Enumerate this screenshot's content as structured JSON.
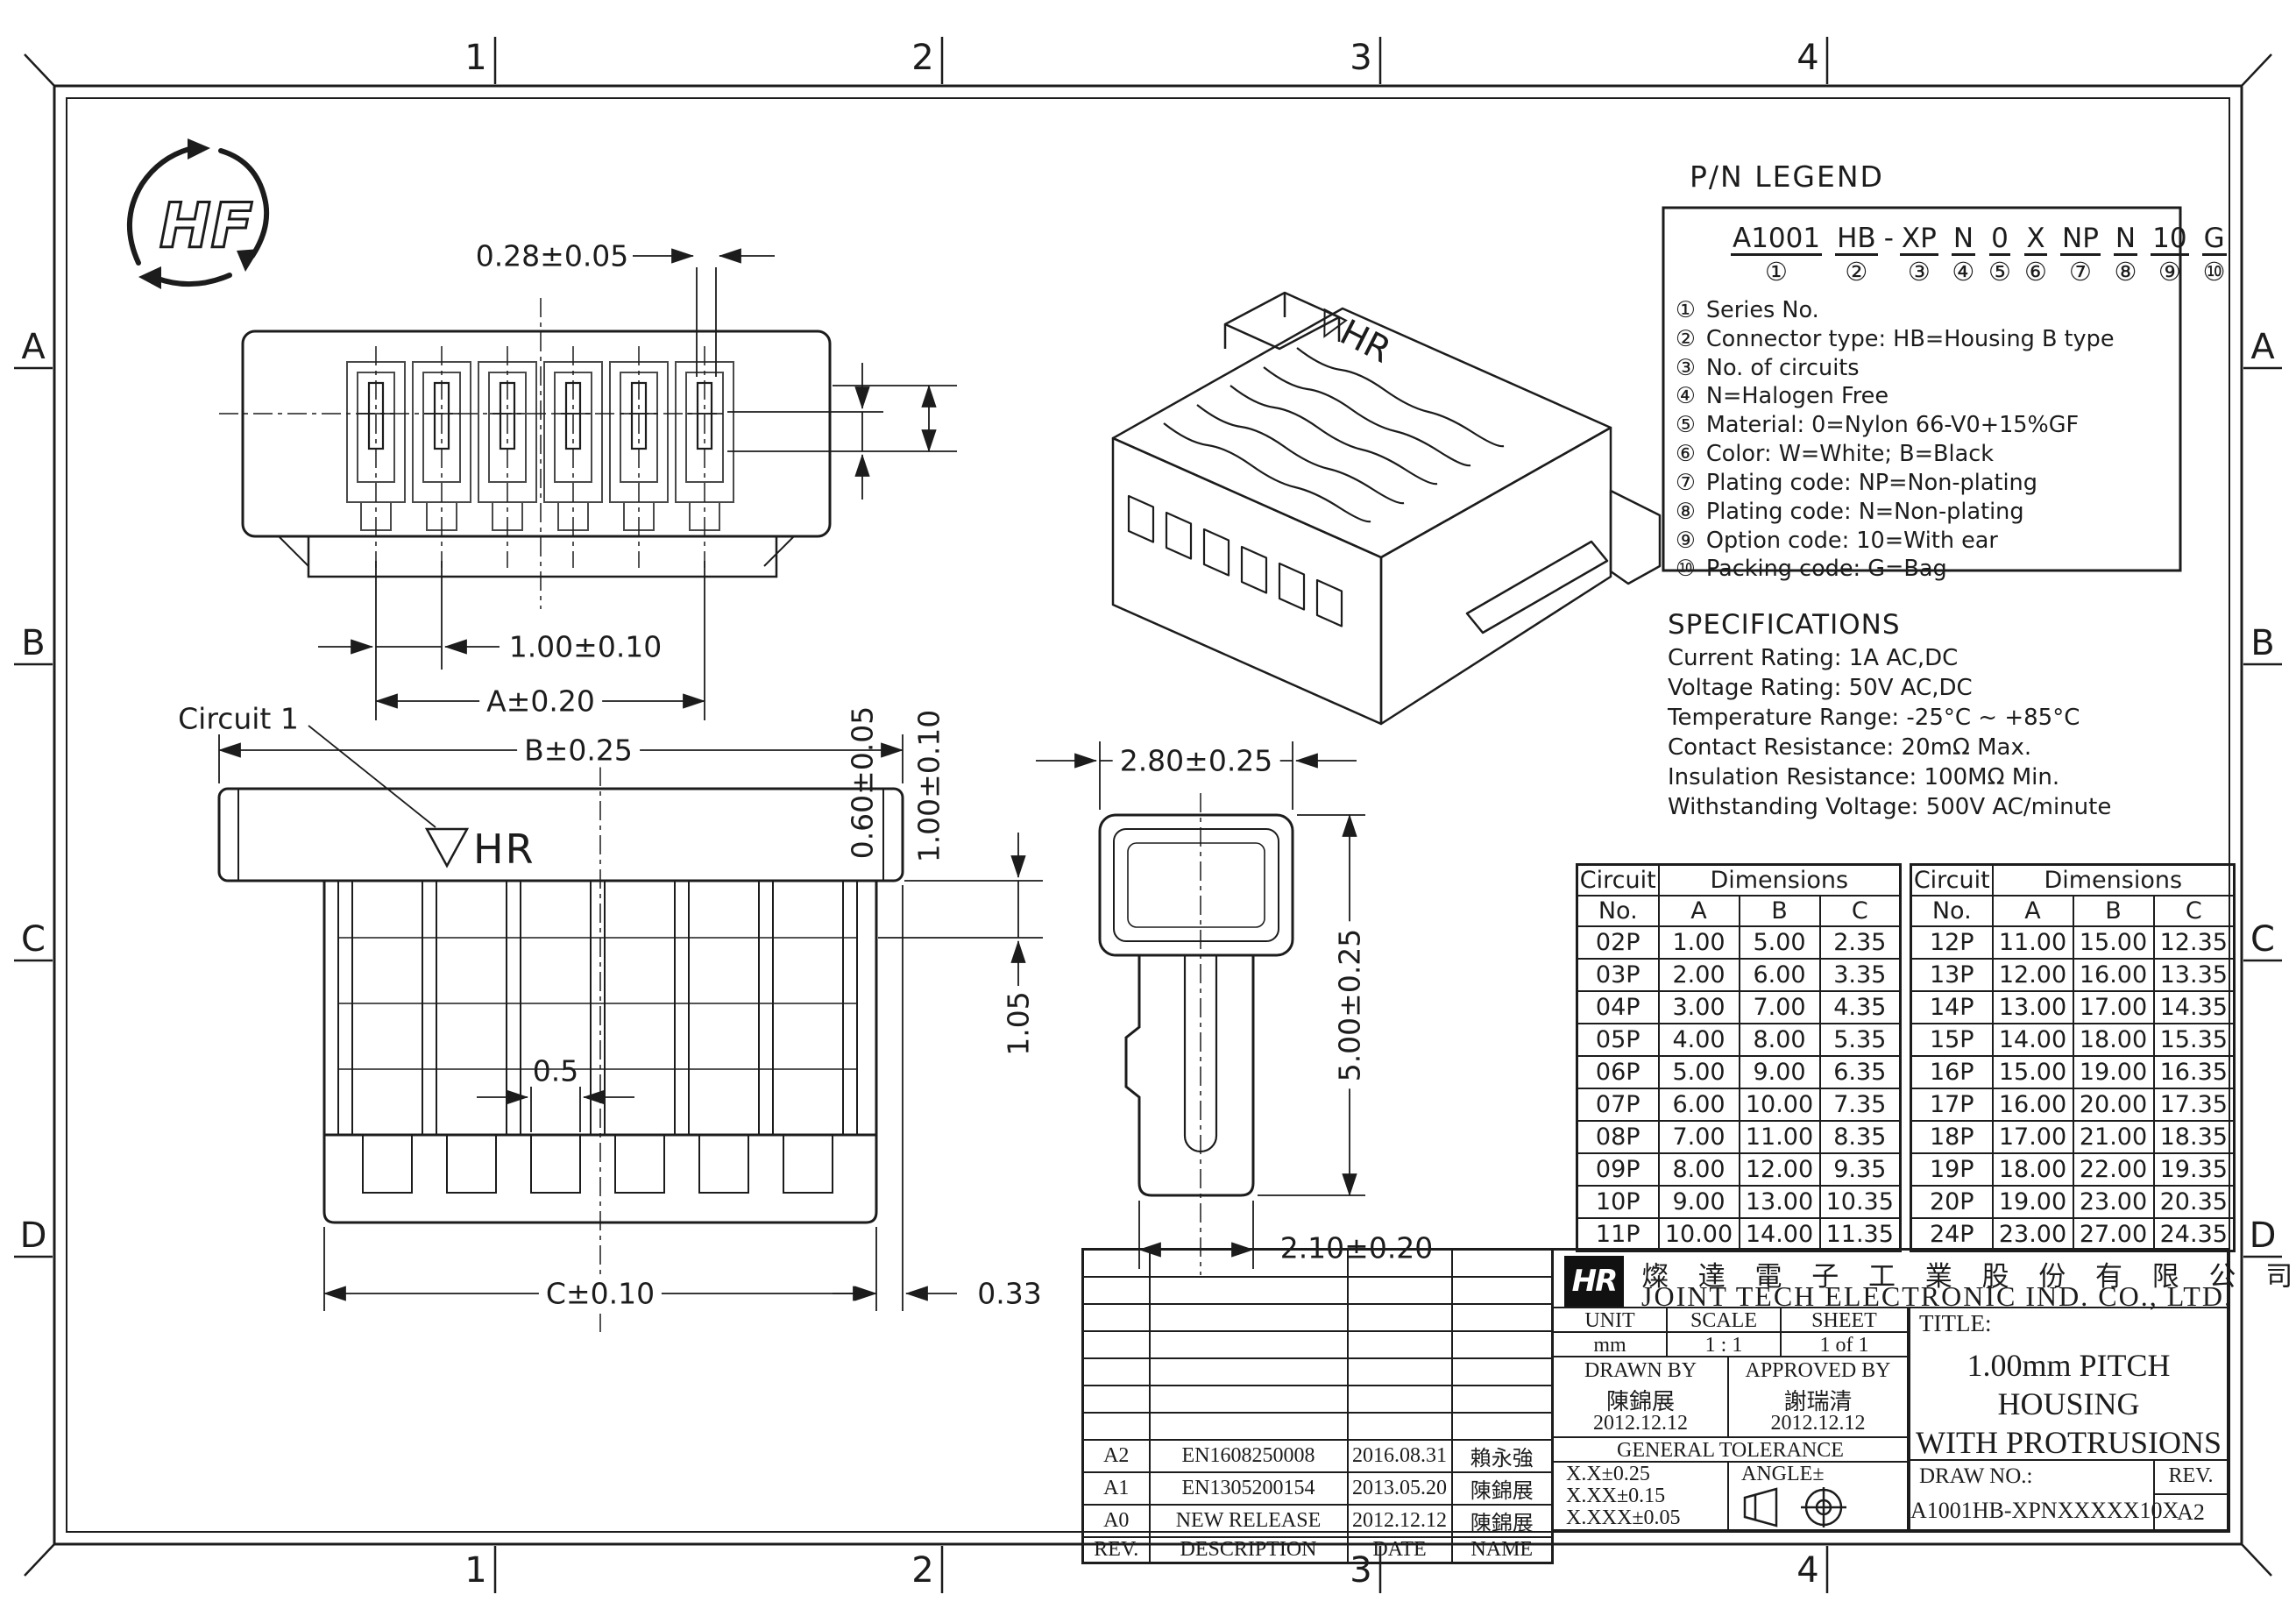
{
  "sheet": {
    "grid_cols": [
      "1",
      "2",
      "3",
      "4"
    ],
    "grid_rows": [
      "A",
      "B",
      "C",
      "D"
    ],
    "hf_mark": "HF"
  },
  "views": {
    "top_view": {
      "dim_contact_width": "0.28±0.05",
      "dim_pitch": "1.00±0.10",
      "dim_overall": "A±0.20",
      "dim_height1": "0.60±0.05",
      "dim_height2": "1.00±0.10"
    },
    "front_view": {
      "circuit_label": "Circuit 1",
      "marking_triangle": "▽",
      "marking": "HR",
      "dim_width": "B±0.25",
      "dim_wall": "1.05",
      "dim_tooth": "0.5",
      "dim_bottom_width": "C±0.10",
      "dim_offset": "0.33"
    },
    "side_view": {
      "dim_width": "2.80±0.25",
      "dim_height": "5.00±0.25",
      "dim_bottom_width": "2.10±0.20"
    },
    "iso_view": {
      "marking_triangle": "▽",
      "marking": "HR"
    }
  },
  "pn_legend": {
    "title": "P/N LEGEND",
    "segments": [
      {
        "t": "A1001",
        "n": "①"
      },
      {
        "t": "HB",
        "n": "②"
      },
      {
        "t": "-",
        "n": ""
      },
      {
        "t": "XP",
        "n": "③"
      },
      {
        "t": "N",
        "n": "④"
      },
      {
        "t": "0",
        "n": "⑤"
      },
      {
        "t": "X",
        "n": "⑥"
      },
      {
        "t": "NP",
        "n": "⑦"
      },
      {
        "t": "N",
        "n": "⑧"
      },
      {
        "t": "10",
        "n": "⑨"
      },
      {
        "t": "G",
        "n": "⑩"
      }
    ],
    "items": [
      {
        "n": "①",
        "text": "Series No."
      },
      {
        "n": "②",
        "text": "Connector type: HB=Housing B type"
      },
      {
        "n": "③",
        "text": "No. of circuits"
      },
      {
        "n": "④",
        "text": "N=Halogen Free"
      },
      {
        "n": "⑤",
        "text": "Material: 0=Nylon 66-V0+15%GF"
      },
      {
        "n": "⑥",
        "text": "Color: W=White; B=Black"
      },
      {
        "n": "⑦",
        "text": "Plating code: NP=Non-plating"
      },
      {
        "n": "⑧",
        "text": "Plating code: N=Non-plating"
      },
      {
        "n": "⑨",
        "text": "Option code: 10=With ear"
      },
      {
        "n": "⑩",
        "text": "Packing code: G=Bag"
      }
    ]
  },
  "specifications": {
    "title": "SPECIFICATIONS",
    "lines": [
      "Current Rating: 1A AC,DC",
      "Voltage Rating: 50V AC,DC",
      "Temperature Range: -25°C ~ +85°C",
      "Contact Resistance: 20mΩ Max.",
      "Insulation Resistance: 100MΩ Min.",
      "Withstanding Voltage: 500V AC/minute"
    ]
  },
  "dimensions_table": {
    "circuit_header": "Circuit",
    "no_header": "No.",
    "dims_header": "Dimensions",
    "col_a": "A",
    "col_b": "B",
    "col_c": "C",
    "left_rows": [
      [
        "02P",
        "1.00",
        "5.00",
        "2.35"
      ],
      [
        "03P",
        "2.00",
        "6.00",
        "3.35"
      ],
      [
        "04P",
        "3.00",
        "7.00",
        "4.35"
      ],
      [
        "05P",
        "4.00",
        "8.00",
        "5.35"
      ],
      [
        "06P",
        "5.00",
        "9.00",
        "6.35"
      ],
      [
        "07P",
        "6.00",
        "10.00",
        "7.35"
      ],
      [
        "08P",
        "7.00",
        "11.00",
        "8.35"
      ],
      [
        "09P",
        "8.00",
        "12.00",
        "9.35"
      ],
      [
        "10P",
        "9.00",
        "13.00",
        "10.35"
      ],
      [
        "11P",
        "10.00",
        "14.00",
        "11.35"
      ]
    ],
    "right_rows": [
      [
        "12P",
        "11.00",
        "15.00",
        "12.35"
      ],
      [
        "13P",
        "12.00",
        "16.00",
        "13.35"
      ],
      [
        "14P",
        "13.00",
        "17.00",
        "14.35"
      ],
      [
        "15P",
        "14.00",
        "18.00",
        "15.35"
      ],
      [
        "16P",
        "15.00",
        "19.00",
        "16.35"
      ],
      [
        "17P",
        "16.00",
        "20.00",
        "17.35"
      ],
      [
        "18P",
        "17.00",
        "21.00",
        "18.35"
      ],
      [
        "19P",
        "18.00",
        "22.00",
        "19.35"
      ],
      [
        "20P",
        "19.00",
        "23.00",
        "20.35"
      ],
      [
        "24P",
        "23.00",
        "27.00",
        "24.35"
      ]
    ]
  },
  "revision_table": {
    "headers": [
      "REV.",
      "DESCRIPTION",
      "DATE",
      "NAME"
    ],
    "rows": [
      [
        "A2",
        "EN1608250008",
        "2016.08.31",
        "賴永強"
      ],
      [
        "A1",
        "EN1305200154",
        "2013.05.20",
        "陳錦展"
      ],
      [
        "A0",
        "NEW RELEASE",
        "2012.12.12",
        "陳錦展"
      ]
    ]
  },
  "title_block": {
    "logo_text": "HR",
    "company_cn": "燦 達 電 子 工 業 股 份 有 限 公 司",
    "company_en": "JOINT TECH ELECTRONIC IND. CO., LTD.",
    "unit_label": "UNIT",
    "unit_value": "mm",
    "scale_label": "SCALE",
    "scale_value": "1 : 1",
    "sheet_label": "SHEET",
    "sheet_value": "1 of 1",
    "drawn_by_label": "DRAWN BY",
    "drawn_by_name": "陳錦展",
    "drawn_by_date": "2012.12.12",
    "approved_by_label": "APPROVED BY",
    "approved_by_name": "謝瑞清",
    "approved_by_date": "2012.12.12",
    "general_tolerance_label": "GENERAL TOLERANCE",
    "tol_line1": "X.X±0.25",
    "tol_line2": "X.XX±0.15",
    "tol_line3": "X.XXX±0.05",
    "angle_label": "ANGLE±",
    "title_label": "TITLE:",
    "title_line1": "1.00mm PITCH",
    "title_line2": "HOUSING",
    "title_line3": "WITH PROTRUSIONS",
    "draw_no_label": "DRAW NO.:",
    "draw_no_value": "A1001HB-XPNXXXXX10X",
    "rev_label": "REV.",
    "rev_value": "A2"
  }
}
